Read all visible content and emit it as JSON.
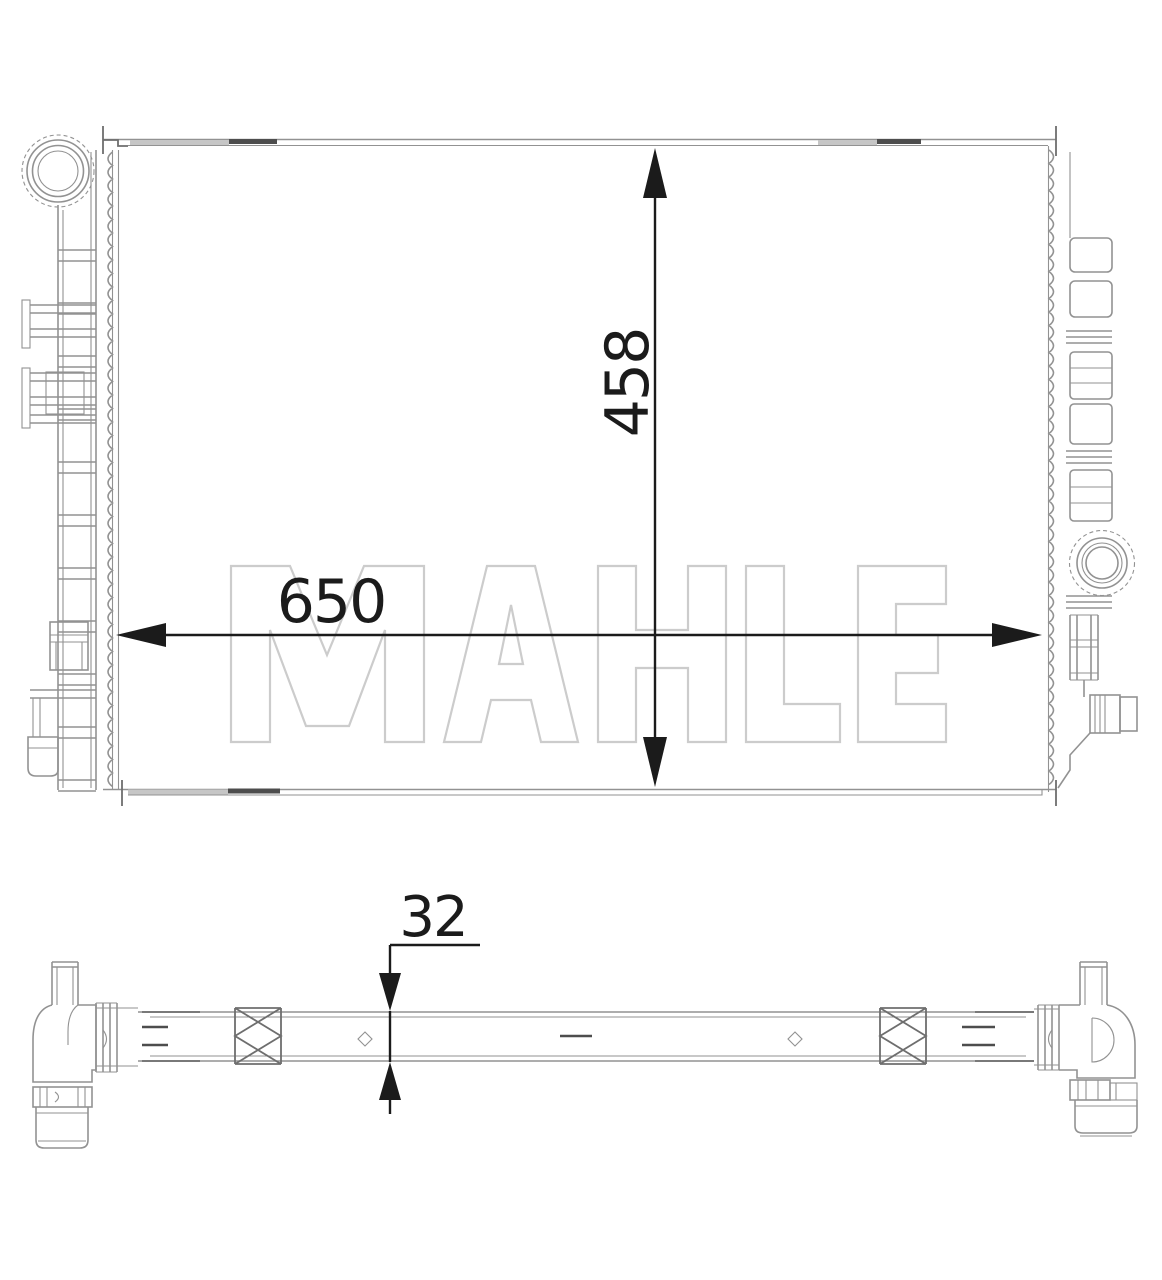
{
  "drawing": {
    "watermark": "MAHLE",
    "dimensions": {
      "width": "650",
      "height": "458",
      "thickness": "32"
    },
    "colors": {
      "background": "#ffffff",
      "line": "#929292",
      "line2": "#6e6e6e",
      "soft": "#c6c6c6",
      "dark": "#4d4d4d",
      "dimension": "#1b1b1b",
      "watermark": "#cccccc"
    }
  }
}
